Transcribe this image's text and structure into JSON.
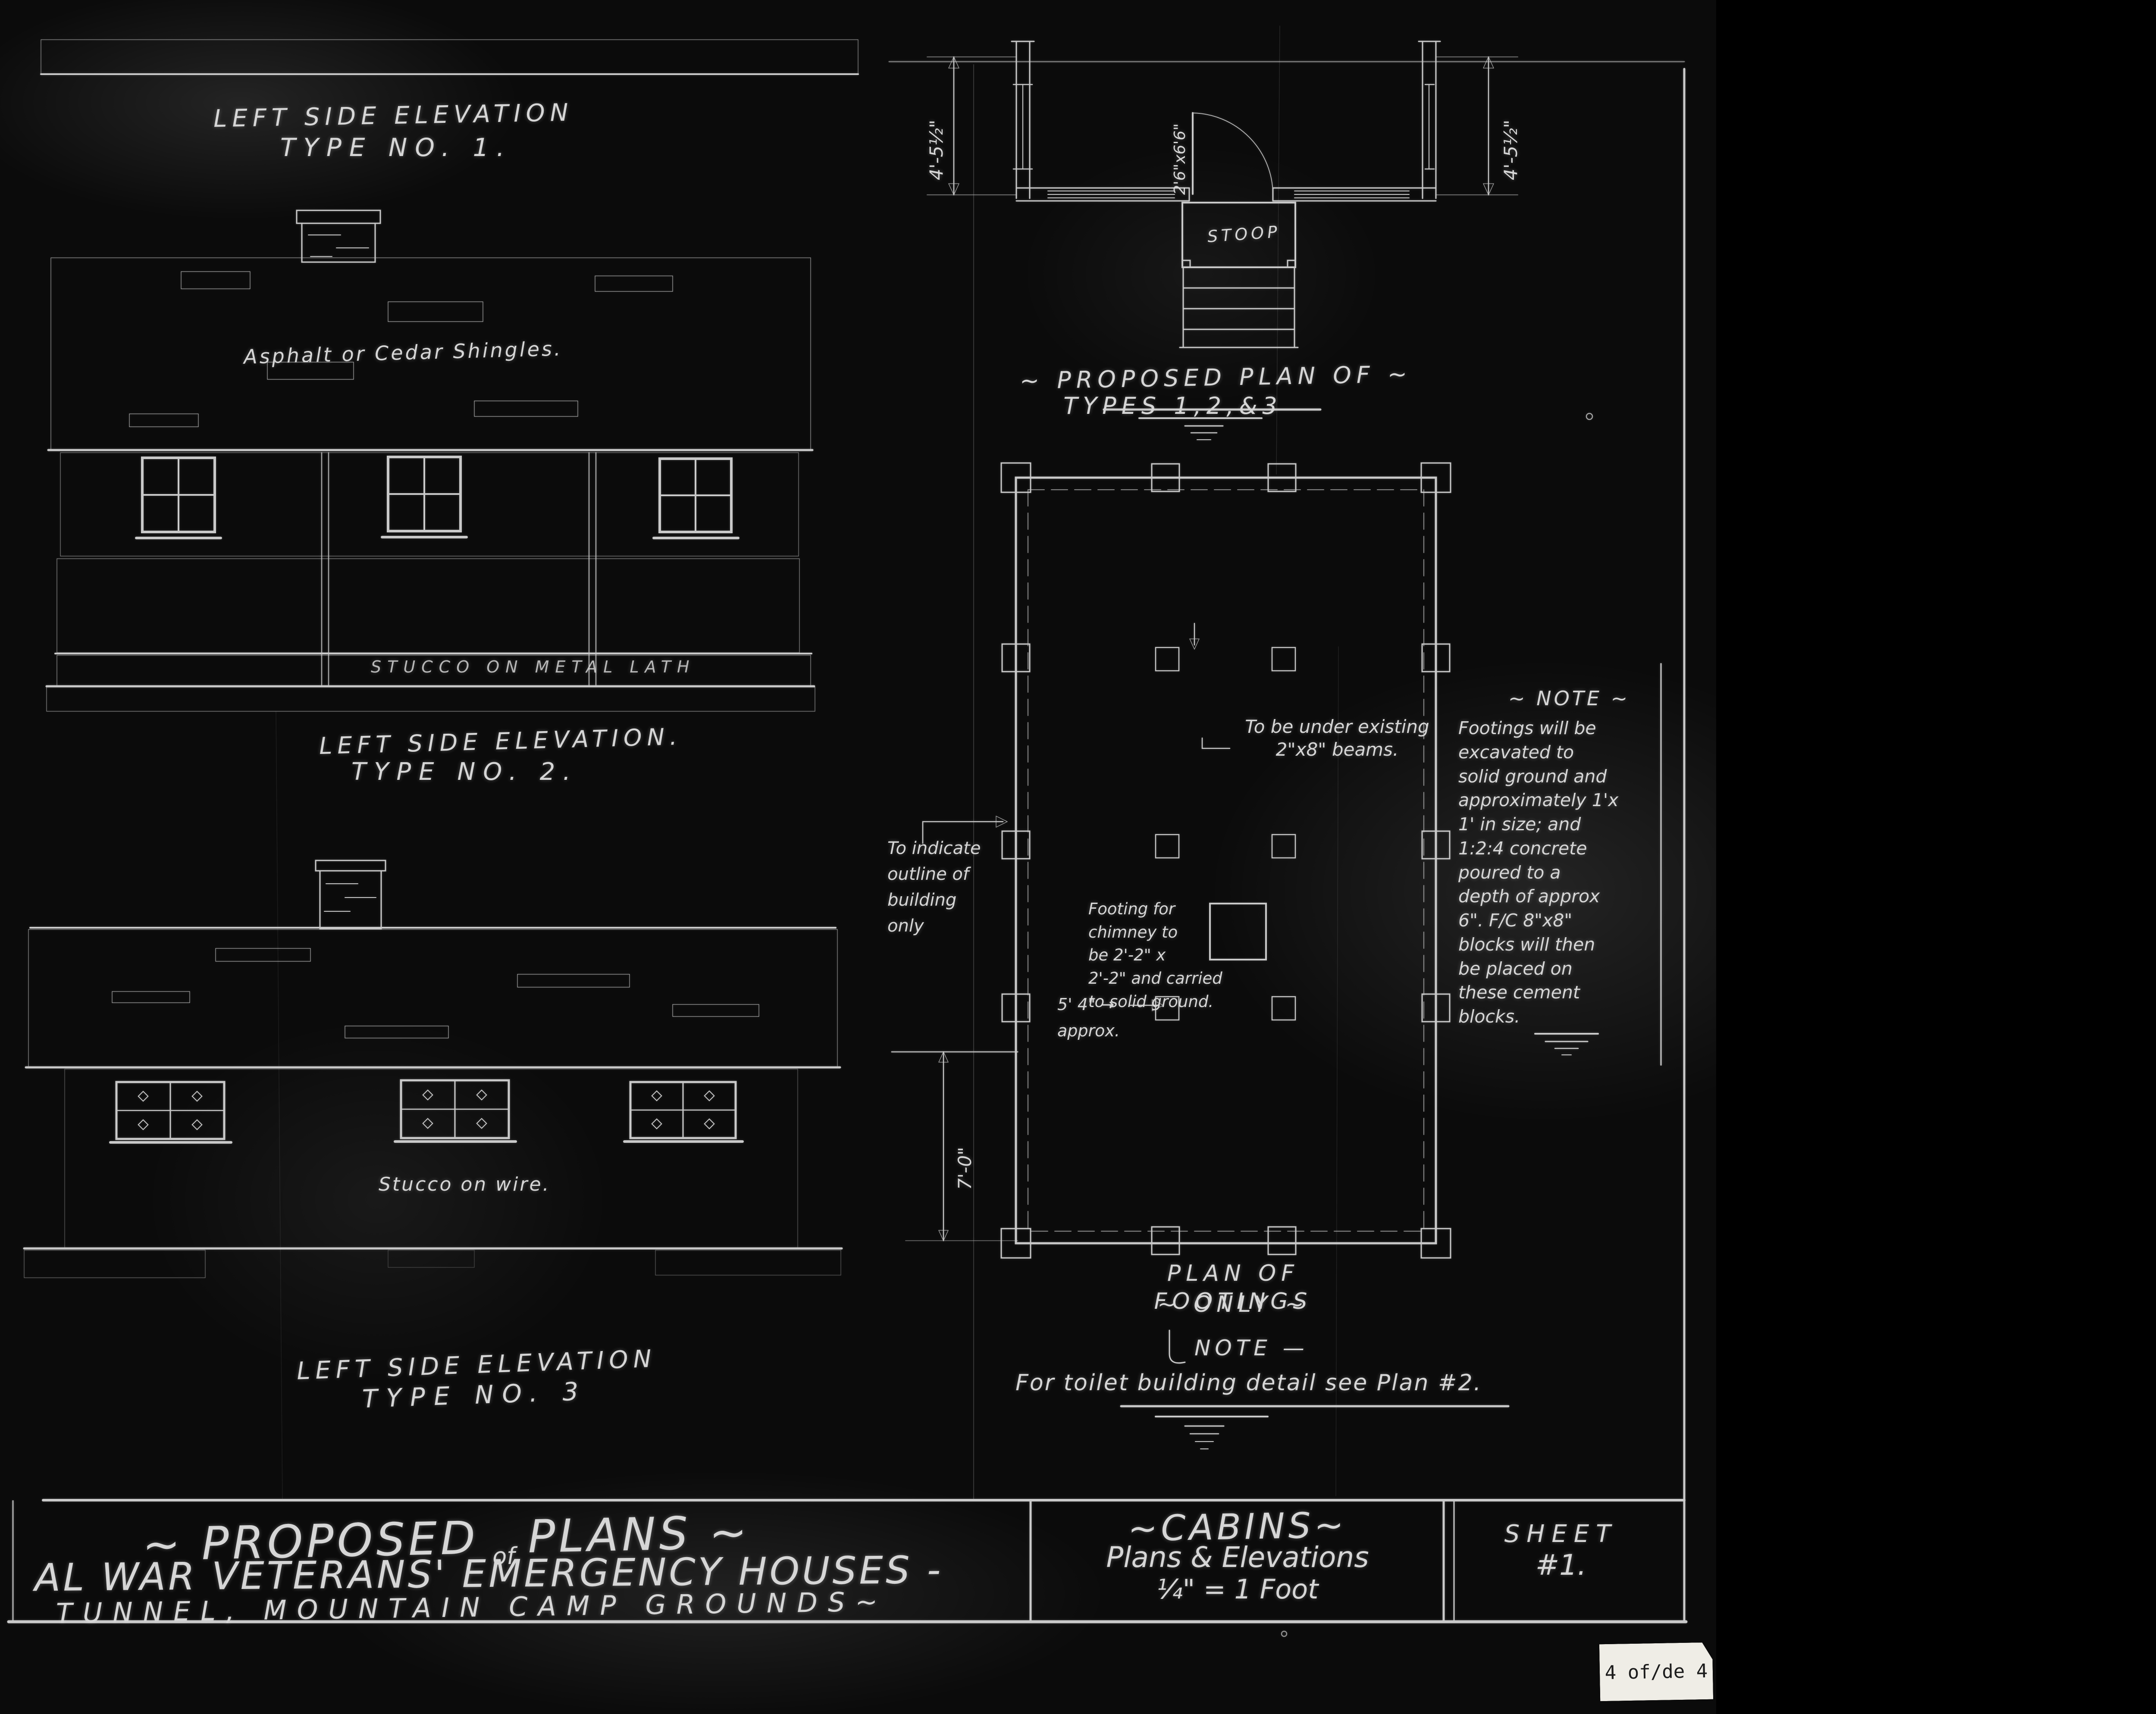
{
  "elevations": {
    "type1": {
      "title": "LEFT SIDE ELEVATION",
      "subtitle": "TYPE NO. 1.",
      "roof_label": "Asphalt or Cedar Shingles.",
      "base_label": "STUCCO ON METAL LATH"
    },
    "type2": {
      "title": "LEFT SIDE ELEVATION.",
      "subtitle": "TYPE NO. 2.",
      "wall_label": "Stucco on wire."
    },
    "type3": {
      "title": "LEFT SIDE ELEVATION",
      "subtitle": "TYPE NO. 3"
    }
  },
  "floor_plan": {
    "title": "~ PROPOSED PLAN OF ~",
    "subtitle": "TYPES 1,2,&3",
    "stoop_label": "STOOP",
    "door_size": "2'6\"x6'6\"",
    "left_dim": "4'-5½\"",
    "right_dim": "4'-5½\""
  },
  "footings_plan": {
    "title": "PLAN OF FOOTINGS",
    "subtitle": "~ ONLY ~",
    "beam_note": "To be under existing\n2\"x8\" beams.",
    "outline_note": "To indicate\noutline of\nbuilding\nonly",
    "chimney_note": "Footing for\nchimney to\nbe 2'-2\" x\n2'-2\" and carried\nto solid ground.",
    "approx_note": "5' 4\" →\napprox.",
    "height_dim": "7'-0\"",
    "side_note_title": "~ NOTE ~",
    "side_note_body": "Footings will be\nexcavated to\nsolid ground and\napproximately 1'x\n1' in size; and\n1:2:4 concrete\npoured to a\ndepth of approx\n6\". F/C 8\"x8\"\nblocks will then\nbe placed on\nthese cement\nblocks."
  },
  "general_note": {
    "title": "NOTE —",
    "body": "For toilet building detail see Plan #2."
  },
  "title_block": {
    "line1_a": "~ PROPOSED",
    "line1_of": "of",
    "line1_b": "PLANS ~",
    "line2": "AL  WAR  VETERANS'  EMERGENCY  HOUSES -",
    "line3": "TUNNEL,  MOUNTAIN  CAMP  GROUNDS~",
    "cabins_title": "~CABINS~",
    "cabins_line2": "Plans & Elevations",
    "cabins_line3": "¼\" = 1 Foot",
    "sheet_word": "SHEET",
    "sheet_no": "#1."
  },
  "page_label": "4 of/de 4"
}
